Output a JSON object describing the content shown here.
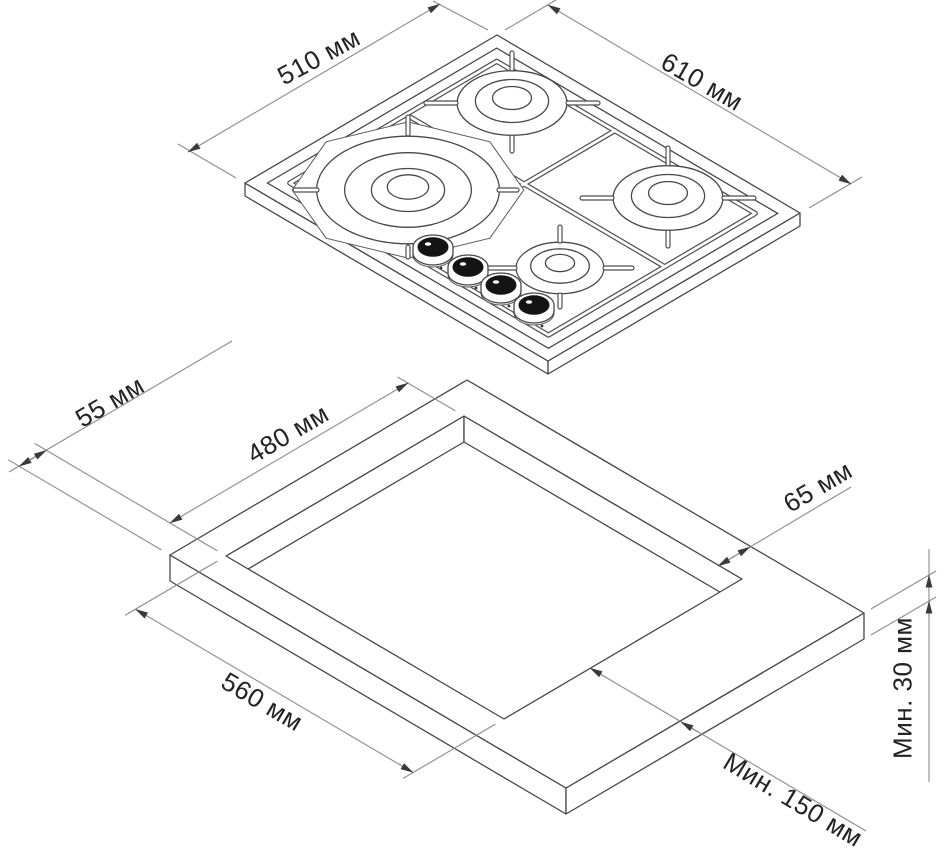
{
  "labels": {
    "hob_side_left": "510 мм",
    "hob_side_right": "610 мм",
    "cutout_offset_left": "55 мм",
    "cutout_side_left": "480 мм",
    "cutout_offset_right": "65 мм",
    "cutout_side_front": "560 мм",
    "worktop_thickness_min": "Мин. 30 мм",
    "cutout_front_clearance_min": "Мин. 150 мм"
  },
  "colors": {
    "object_line": "#474747",
    "dimension_line": "#8c8c8c",
    "text": "#232323",
    "knob": "#141414",
    "background": "#ffffff"
  }
}
